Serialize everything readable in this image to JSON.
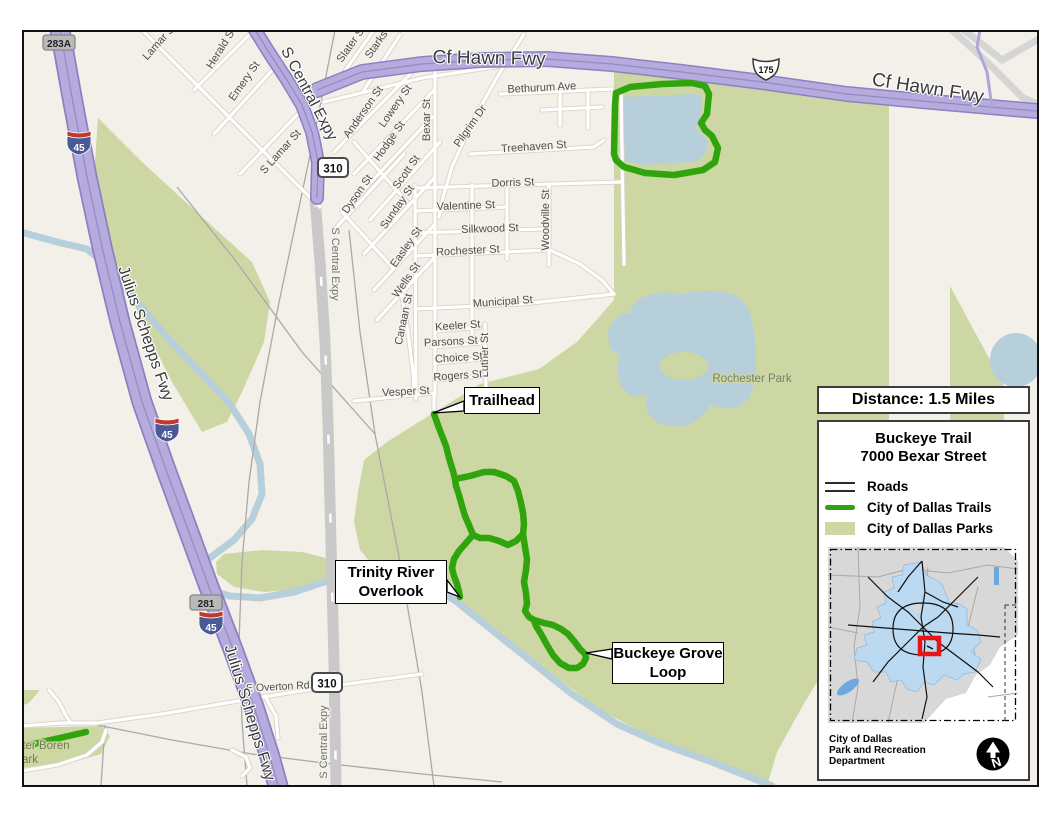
{
  "callouts": {
    "trailhead": "Trailhead",
    "overlook_line1": "Trinity River",
    "overlook_line2": "Overlook",
    "loop_line1": "Buckeye Grove",
    "loop_line2": "Loop"
  },
  "panel": {
    "distance": "Distance: 1.5 Miles",
    "legend_title_line1": "Buckeye Trail",
    "legend_title_line2": "7000 Bexar Street",
    "legend_items": [
      {
        "label": "Roads",
        "icon": "roads-double-line-icon"
      },
      {
        "label": "City of Dallas Trails",
        "icon": "trail-green-line-icon"
      },
      {
        "label": "City of Dallas Parks",
        "icon": "park-swatch-icon"
      }
    ],
    "attribution_line1": "City of Dallas",
    "attribution_line2": "Park and Recreation",
    "attribution_line3": "Department",
    "north_letter": "N"
  },
  "colors": {
    "trail_green": "#2fa40c",
    "park_green": "#cdd7a4",
    "water_blue": "#b7cfda",
    "freeway_purple": "#b6abdd",
    "inset_city_blue": "#bcd9f2",
    "marker_red": "#e81417"
  },
  "map_labels": [
    {
      "t": "Lamar St",
      "x": 160,
      "y": 42,
      "r": -48,
      "s": 11
    },
    {
      "t": "Herald St",
      "x": 222,
      "y": 48,
      "r": -58,
      "s": 11
    },
    {
      "t": "Emery St",
      "x": 245,
      "y": 81,
      "r": -55,
      "s": 11
    },
    {
      "t": "S Lamar St",
      "x": 281,
      "y": 152,
      "r": -48,
      "s": 11
    },
    {
      "t": "Slater St",
      "x": 352,
      "y": 44,
      "r": -55,
      "s": 11
    },
    {
      "t": "Starks St",
      "x": 381,
      "y": 39,
      "r": -55,
      "s": 11
    },
    {
      "t": "Anderson St",
      "x": 364,
      "y": 112,
      "r": -55,
      "s": 11
    },
    {
      "t": "Lowery St",
      "x": 396,
      "y": 106,
      "r": -55,
      "s": 11
    },
    {
      "t": "Hodge St",
      "x": 390,
      "y": 141,
      "r": -55,
      "s": 11
    },
    {
      "t": "Scott St",
      "x": 407,
      "y": 172,
      "r": -55,
      "s": 11
    },
    {
      "t": "Dyson St",
      "x": 358,
      "y": 194,
      "r": -55,
      "s": 11
    },
    {
      "t": "Sunday St",
      "x": 398,
      "y": 207,
      "r": -55,
      "s": 11
    },
    {
      "t": "Easley St",
      "x": 407,
      "y": 247,
      "r": -55,
      "s": 11
    },
    {
      "t": "Wells St",
      "x": 407,
      "y": 280,
      "r": -55,
      "s": 11
    },
    {
      "t": "Canaan St",
      "x": 405,
      "y": 318,
      "r": -78,
      "s": 11
    },
    {
      "t": "Bexar St",
      "x": 428,
      "y": 118,
      "r": -90,
      "s": 11
    },
    {
      "t": "Pilgrim Dr",
      "x": 471,
      "y": 126,
      "r": -55,
      "s": 11
    },
    {
      "t": "Woodville St",
      "x": 547,
      "y": 218,
      "r": -90,
      "s": 11
    },
    {
      "t": "Luther St",
      "x": 486,
      "y": 353,
      "r": -90,
      "s": 11
    },
    {
      "t": "Bethurum Ave",
      "x": 540,
      "y": 89,
      "r": -3,
      "s": 11
    },
    {
      "t": "Treehaven St",
      "x": 532,
      "y": 148,
      "r": -4,
      "s": 11
    },
    {
      "t": "Dorris St",
      "x": 511,
      "y": 184,
      "r": -2,
      "s": 11
    },
    {
      "t": "Valentine St",
      "x": 464,
      "y": 207,
      "r": -2,
      "s": 11
    },
    {
      "t": "Silkwood St",
      "x": 488,
      "y": 230,
      "r": -2,
      "s": 11
    },
    {
      "t": "Rochester St",
      "x": 466,
      "y": 252,
      "r": -3,
      "s": 11
    },
    {
      "t": "Municipal St",
      "x": 501,
      "y": 303,
      "r": -4,
      "s": 11
    },
    {
      "t": "Keeler St",
      "x": 456,
      "y": 327,
      "r": -4,
      "s": 11
    },
    {
      "t": "Parsons St",
      "x": 449,
      "y": 343,
      "r": -3,
      "s": 11
    },
    {
      "t": "Choice St",
      "x": 457,
      "y": 359,
      "r": -4,
      "s": 11
    },
    {
      "t": "Rogers St",
      "x": 456,
      "y": 377,
      "r": -4,
      "s": 11
    },
    {
      "t": "Vesper St",
      "x": 404,
      "y": 393,
      "r": -3,
      "s": 11
    },
    {
      "t": "E Overton Rd",
      "x": 276,
      "y": 688,
      "r": -3,
      "s": 10.5
    },
    {
      "t": "Rochester Park",
      "x": 750,
      "y": 380,
      "r": 0,
      "s": 11.5,
      "cls": "pk"
    },
    {
      "t": "Cf Hawn Fwy",
      "x": 487,
      "y": 62,
      "r": 1,
      "s": 19,
      "cls": "hw"
    },
    {
      "t": "Cf Hawn Fwy",
      "x": 925,
      "y": 92,
      "r": 9,
      "s": 19,
      "cls": "hw"
    },
    {
      "t": "Julius Schepps Fwy",
      "x": 139,
      "y": 333,
      "r": 71,
      "s": 16,
      "cls": "hw"
    },
    {
      "t": "Julius Schepps Fwy",
      "x": 243,
      "y": 712,
      "r": 73,
      "s": 16,
      "cls": "hw"
    },
    {
      "t": "S Central Expy",
      "x": 303,
      "y": 94,
      "r": 62,
      "s": 15.5,
      "cls": "hw"
    },
    {
      "t": "S Central Expy",
      "x": 330,
      "y": 262,
      "r": 90,
      "s": 11,
      "cls": "gray"
    },
    {
      "t": "S Central Expy",
      "x": 325,
      "y": 740,
      "r": -90,
      "s": 11,
      "cls": "gray"
    },
    {
      "t": "ter Boren",
      "x": 44,
      "y": 747,
      "r": 0,
      "s": 11.5,
      "cls": "bo"
    },
    {
      "t": "ark",
      "x": 28,
      "y": 761,
      "r": 0,
      "s": 11.5,
      "cls": "bo"
    }
  ],
  "shields": [
    {
      "kind": "interstate",
      "label": "45",
      "x": 77,
      "y": 140
    },
    {
      "kind": "interstate",
      "label": "45",
      "x": 165,
      "y": 427
    },
    {
      "kind": "interstate",
      "label": "45",
      "x": 209,
      "y": 620
    },
    {
      "kind": "us",
      "label": "175",
      "x": 764,
      "y": 66
    },
    {
      "kind": "state",
      "label": "310",
      "x": 331,
      "y": 166
    },
    {
      "kind": "state",
      "label": "310",
      "x": 325,
      "y": 681
    },
    {
      "kind": "exit",
      "label": "283A",
      "x": 57,
      "y": 41
    },
    {
      "kind": "exit",
      "label": "281",
      "x": 204,
      "y": 601
    }
  ]
}
